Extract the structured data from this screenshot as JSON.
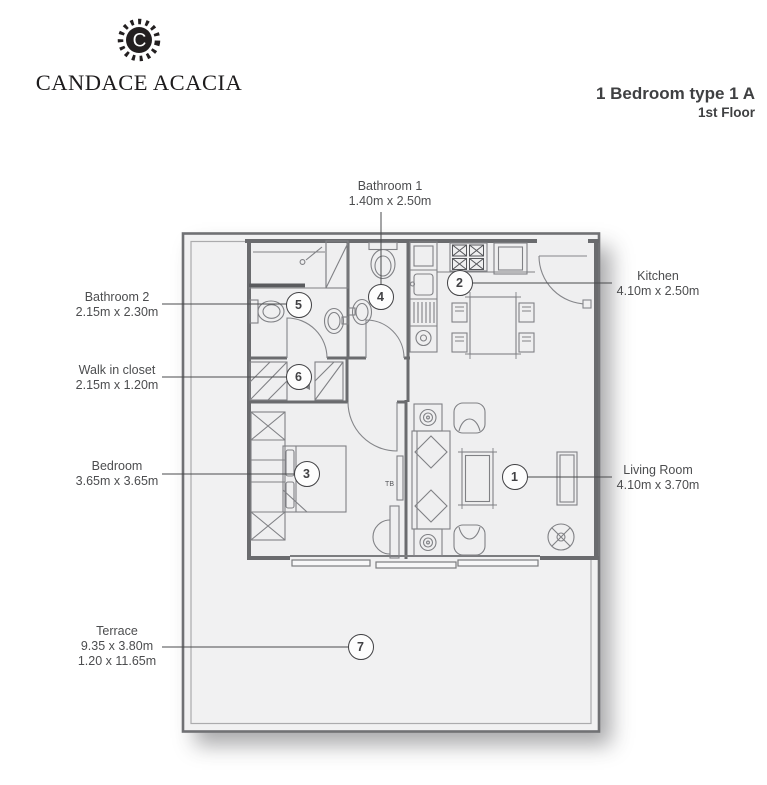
{
  "brand": {
    "name": "CANDACE ACACIA",
    "logo_letter": "C"
  },
  "title": {
    "main": "1 Bedroom type 1 A",
    "sub": "1st Floor"
  },
  "rooms": [
    {
      "id": 1,
      "name": "Living Room",
      "dims": "4.10m x 3.70m"
    },
    {
      "id": 2,
      "name": "Kitchen",
      "dims": "4.10m x 2.50m"
    },
    {
      "id": 3,
      "name": "Bedroom",
      "dims": "3.65m x 3.65m"
    },
    {
      "id": 4,
      "name": "Bathroom 1",
      "dims": "1.40m x 2.50m"
    },
    {
      "id": 5,
      "name": "Bathroom 2",
      "dims": "2.15m x 2.30m"
    },
    {
      "id": 6,
      "name": "Walk in closet",
      "dims": "2.15m x 1.20m"
    },
    {
      "id": 7,
      "name": "Terrace",
      "dims": "9.35 x 3.80m",
      "dims2": "1.20 x 11.65m"
    }
  ],
  "plan": {
    "tv_label": "TB"
  },
  "colors": {
    "ink": "#231f20",
    "label_text": "#4c4d4f",
    "wall": "#6a6b6e",
    "plan_fill": "#f1f1f2"
  }
}
